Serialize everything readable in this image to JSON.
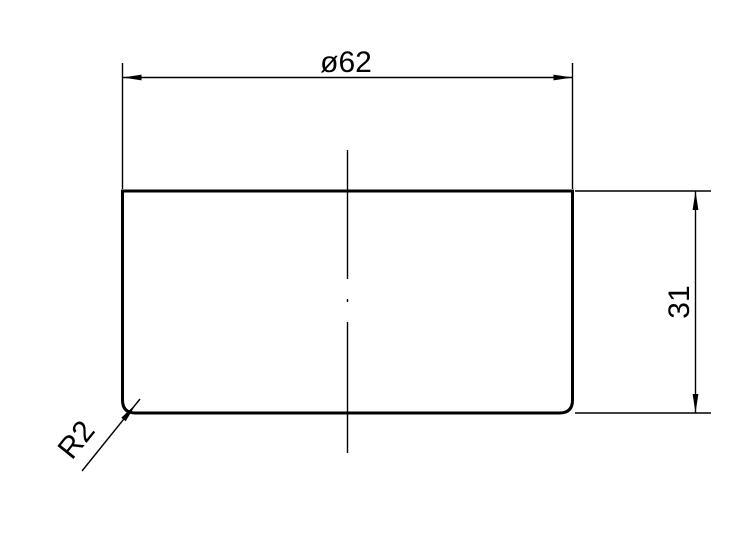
{
  "drawing": {
    "colors": {
      "ink": "#000000",
      "background": "#ffffff"
    },
    "dimensions": {
      "diameter": {
        "label": "ø62",
        "symbol": "ø",
        "value": 62
      },
      "height": {
        "label": "31",
        "value": 31
      },
      "corner_radius": {
        "label": "R2",
        "value": 2
      }
    }
  }
}
